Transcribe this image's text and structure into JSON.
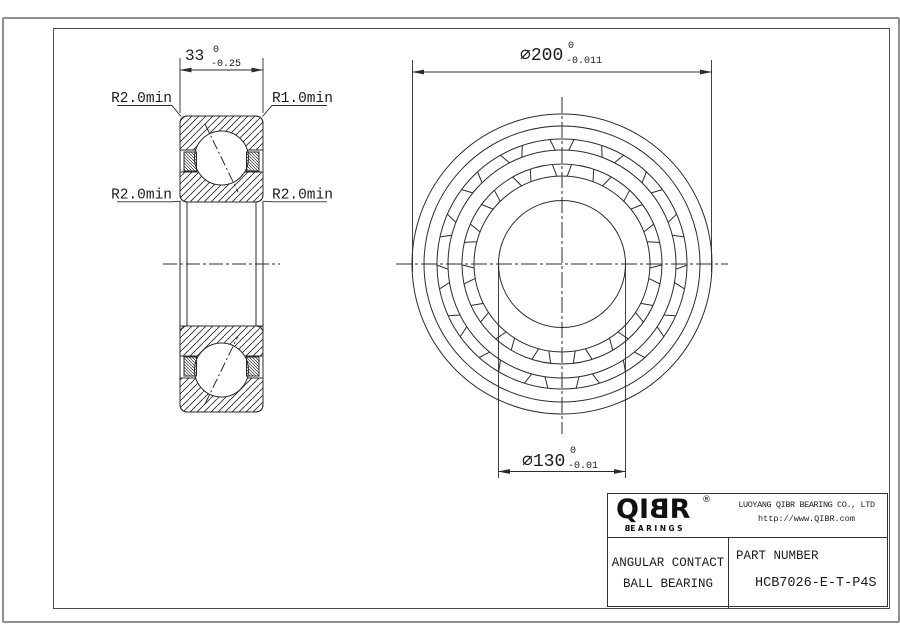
{
  "section_view": {
    "width_dim": {
      "value": "33",
      "tol_upper": "0",
      "tol_lower": "-0.25"
    },
    "labels": {
      "top_left": "R2.0min",
      "top_right": "R1.0min",
      "bottom_left": "R2.0min",
      "bottom_right": "R2.0min"
    }
  },
  "front_view": {
    "outer_dim": {
      "value": "⌀200",
      "tol_upper": "0",
      "tol_lower": "-0.011"
    },
    "bore_dim": {
      "value": "⌀130",
      "tol_upper": "0",
      "tol_lower": "-0.01"
    },
    "cage_pocket_count": 15
  },
  "title_block": {
    "logo": {
      "part1": "QI",
      "part2": "B",
      "part3": "R",
      "registered": "®",
      "sub1": "B",
      "sub2": "EARINGS"
    },
    "company": "LUOYANG QIBR BEARING CO., LTD",
    "website": "http://www.QIBR.com",
    "product_type_line1": "ANGULAR CONTACT",
    "product_type_line2": "BALL BEARING",
    "part_number_label": "PART NUMBER",
    "part_number": "HCB7026-E-T-P4S"
  },
  "colors": {
    "line": "#2b2b2b",
    "sheet_edge": "#8f8f8f",
    "frame": "#4a4a4a"
  }
}
